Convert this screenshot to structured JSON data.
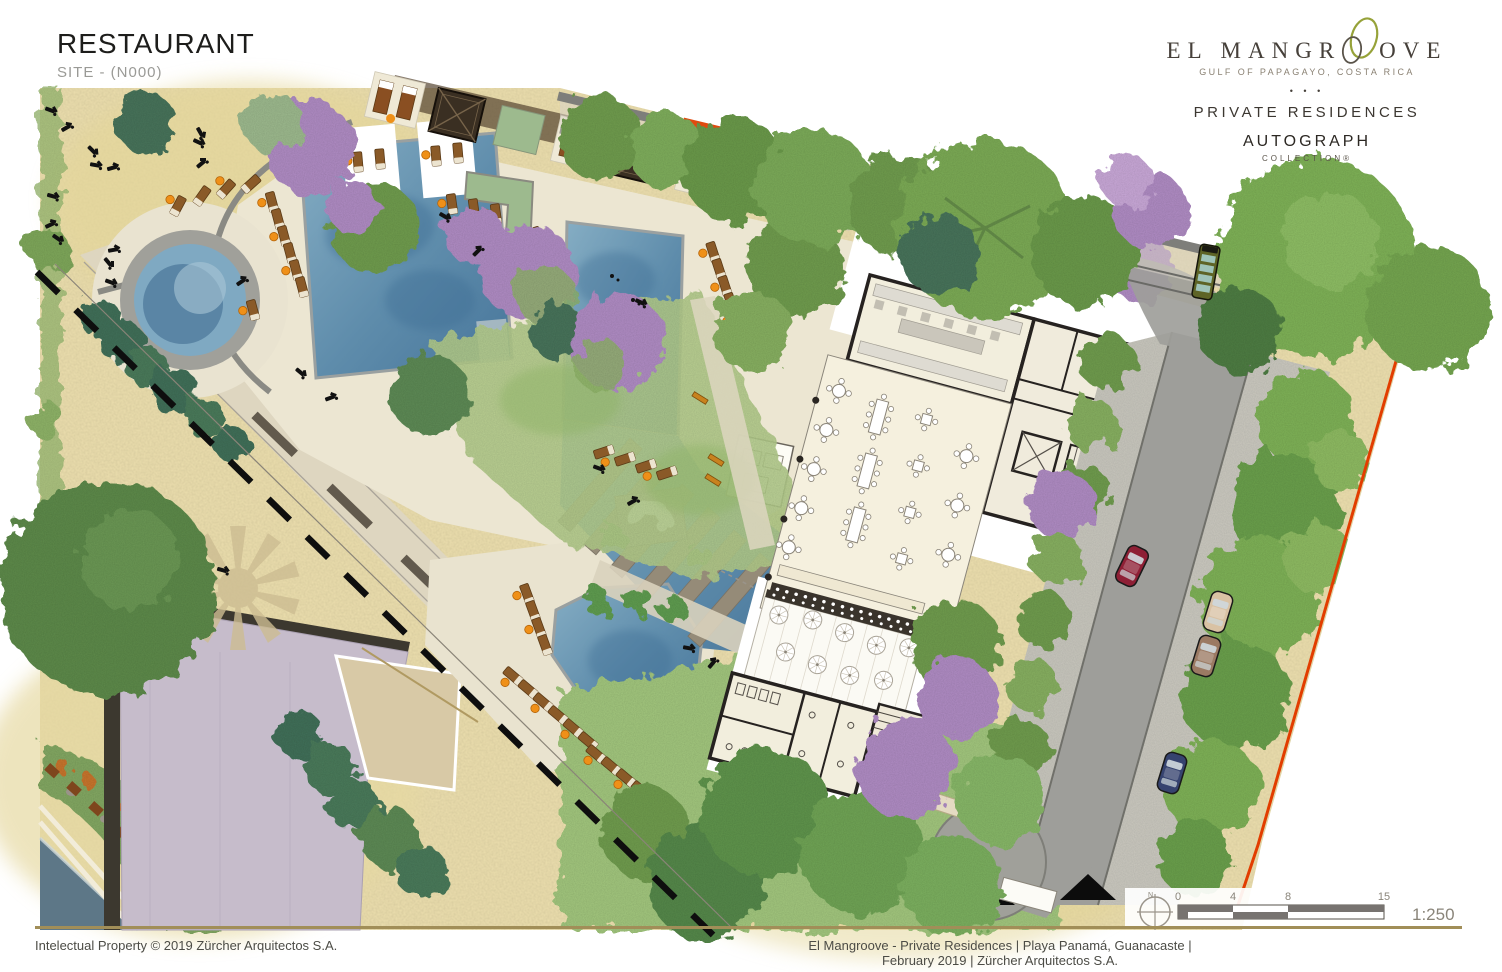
{
  "sheet": {
    "title": "RESTAURANT",
    "subtitle": "SITE - (N000)"
  },
  "brand": {
    "wordmark_left": "EL MANGR",
    "wordmark_right": "OVE",
    "location": "GULF OF PAPAGAYO, COSTA RICA",
    "separator_dots": "• • •",
    "residences": "PRIVATE RESIDENCES",
    "collection_brand": "AUTOGRAPH",
    "collection_sub": "COLLECTION®",
    "accent_green": "#96a239",
    "text_dark": "#46403a"
  },
  "footer": {
    "left": "Intelectual Property © 2019 Zürcher Arquitectos S.A.",
    "right": "El Mangroove - Private Residences | Playa Panamá, Guanacaste | February 2019 | Zürcher Arquitectos S.A.",
    "rule_color": "#a18e58"
  },
  "scalebar": {
    "north_label": "N",
    "ticks": [
      "0",
      "4",
      "8",
      "15"
    ],
    "meters": [
      0,
      4,
      8,
      15
    ],
    "ratio": "1:250"
  },
  "palette": {
    "sand": "#ecdfae",
    "pool_deck_cream": "#ece6d2",
    "pool_water": "#6f9cb8",
    "pool_deep": "#3a6a92",
    "lawn": "#aecb85",
    "canopy_green": "#6f9c4e",
    "canopy_light": "#87b060",
    "tree_teal": "#3f7058",
    "bougainvillea": "#b08cc4",
    "road_asphalt": "#9e9e9a",
    "gravel": "#c8c6bc",
    "building_floor": "#f4efde",
    "building_wall": "#262220",
    "roof_white": "#ffffff",
    "lavender_roof": "#c6bccb",
    "tan_roof": "#d8c9a6",
    "boundary_dash": "#0e0e0e",
    "property_line": "#e23d00",
    "lounger_wood": "#8a5a28",
    "umbrella_orange": "#ef9018",
    "car_red": "#8e1f35",
    "car_tan": "#d9c2a4",
    "car_brown": "#9b7a63",
    "car_blue": "#36436f",
    "bus_olive": "#5e6426",
    "sea_water": "#5d7787"
  }
}
